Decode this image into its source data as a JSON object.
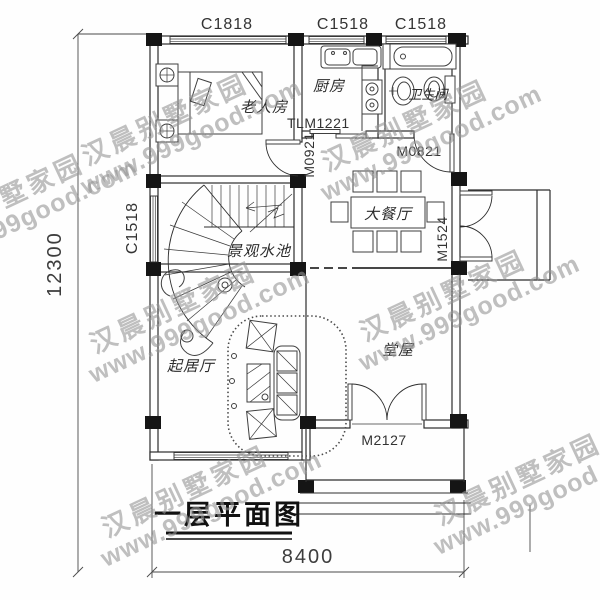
{
  "watermark": {
    "brand": "汉晨别墅家园",
    "site": "www.999good.com"
  },
  "title": {
    "text": "一层平面图"
  },
  "dimensions": {
    "overall_depth": "12300",
    "overall_width": "8400"
  },
  "rooms": {
    "elder_bedroom": "老人房",
    "kitchen": "厨房",
    "bathroom": "卫生间",
    "dining": "大餐厅",
    "water_feature": "景观水池",
    "living": "起居厅",
    "main_hall": "堂屋"
  },
  "windows": {
    "top_left": "C1818",
    "top_middle": "C1518",
    "top_right": "C1518",
    "left_side": "C1518"
  },
  "doors": {
    "kitchen_sliding": "TLM1221",
    "bedroom": "M0921",
    "bathroom": "M0821",
    "dining_side": "M1524",
    "entry": "M2127"
  },
  "colors": {
    "line": "#2d2d2d",
    "column_fill": "#151515",
    "watermark": "#949494",
    "background": "#fefefe"
  }
}
